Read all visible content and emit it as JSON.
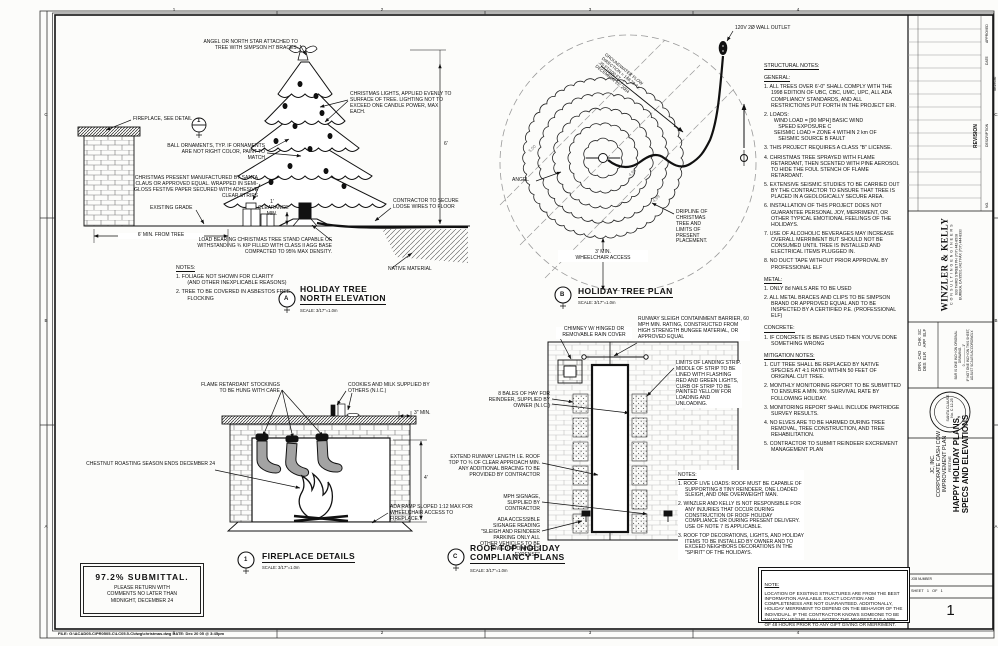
{
  "sheet": {
    "grid_cols": [
      "1",
      "2",
      "3",
      "4"
    ],
    "grid_rows_left": [
      "C",
      "B",
      "A"
    ],
    "grid_rows_right": [
      "C",
      "B",
      "A"
    ],
    "edge_code": "SE29536",
    "footer": "FILE: G:\\ACAD05-C\\PR0505-C\\LC05.5-C\\dwg\\christmas.dwg    DATE: Dec 20 05 @ 3:45pm"
  },
  "tree_elevation": {
    "tag": "A",
    "title": "HOLIDAY TREE\nNORTH ELEVATION",
    "scale": "SCALE: 3/17\"=1.0m",
    "labels": {
      "angel": "ANGEL OR NORTH STAR ATTACHED TO TREE WITH SIMPSON H7 BRACES.",
      "lights": "CHRISTMAS LIGHTS, APPLIED EVENLY TO SURFACE OF TREE. LIGHTING NOT TO EXCEED ONE CANDLE POWER, MAX EACH.",
      "fireplace_ref": "FIREPLACE, SEE DETAIL",
      "detail_ref_num": "1",
      "ornaments": "BALL ORNAMENTS, TYP. IF ORNAMENTS ARE NOT RIGHT COLOR, PAINT TO MATCH",
      "present": "CHRISTMAS PRESENT MANUFACTURED BY SANTA CLAUS OR APPROVED EQUAL. WRAPPED IN SEMI-GLOSS FESTIVE PAPER SECURED WITH ADHESIVE CLEAR STRIPS",
      "existing_grade": "EXISTING GRADE",
      "clearance": "1'\nCLEARANCE\nMIN.",
      "min_from_tree": "6' MIN. FROM TREE",
      "stand": "LOAD BEARING CHRISTMAS TREE STAND CAPABLE OF WITHSTANDING ¾ KIP FILLED WITH CLASS II AGG BASE COMPACTED TO 95% MAX DENSITY.",
      "wires": "CONTRACTOR TO SECURE LOOSE WIRES TO FLOOR",
      "native": "NATIVE MATERIAL",
      "height_dim": "6'"
    },
    "notes_heading": "NOTES:",
    "notes": [
      "1. FOLIAGE NOT SHOWN FOR CLARITY\n   (AND OTHER INEXPLICABLE REASONS)",
      "2. TREE TO BE COVERED IN ASBESTOS FREE\n   FLOCKING"
    ]
  },
  "tree_plan": {
    "tag": "B",
    "title": "HOLIDAY TREE PLAN",
    "scale": "SCALE: 3/17\"=1.0m",
    "labels": {
      "outlet": "120V 2Ø WALL OUTLET",
      "groundwater": "GROUNDWATER FLOW\nDIRECTION = 148.28 Az.\n.25 FT/100 FT.\nDECEMBER 25, 2004",
      "angel": "ANGEL",
      "dripline": "DRIPLINE OF CHRISTMAS TREE AND LIMITS OF PRESENT PLACEMENT.",
      "wheelchair": "3' MIN.\nWHEELCHAIR ACCESS",
      "contours": [
        "5.00",
        "4.98",
        "4.99"
      ]
    }
  },
  "roof_plan": {
    "tag": "C",
    "title": "ROOF TOP HOLIDAY\nCOMPLIANCY PLANS",
    "scale": "SCALE: 3/17\"=1.0m",
    "labels": {
      "chimney": "CHIMNEY W/ HINGED OR REMOVABLE RAIN COVER",
      "barrier": "RUNWAY SLEIGH CONTAINMENT BARRIER, 60 MPH MIN. RATING, CONSTRUCTED FROM HIGH STRENGTH BUNGEE MATERIAL, OR APPROVED EQUAL",
      "limits": "LIMITS OF LANDING STRIP. MIDDLE OF STRIP TO BE LINED WITH FLASHING RED AND GREEN LIGHTS, CURB OF STRIP TO BE PAINTED YELLOW FOR LOADING AND UNLOADING.",
      "hay": "8 BALES OF HAY FOR REINDEER, SUPPLIED BY OWNER (N.I.C.)",
      "runway": "EXTEND RUNWAY LENGTH I.E. ROOF TOP TO ¾ OF CLEAR APPROACH MIN. ANY ADDITIONAL BRACING TO BE PROVIDED BY CONTRACTOR",
      "mph": "MPH SIGNAGE, SUPPLIED BY CONTRACTOR",
      "ada": "ADA ACCESSIBLE SIGNAGE READING \"SLEIGH AND REINDEER PARKING ONLY ALL OTHER VEHICLES TO BE TOWED AT OWNER'S EXPENSE\""
    },
    "notes_heading": "NOTES:",
    "notes": [
      "1. ROOF LIVE LOADS: ROOF MUST BE CAPABLE OF SUPPORTING 8 TINY REINDEER, ONE LOADED SLEIGH, AND ONE OVERWEIGHT MAN.",
      "2. WINZLER AND KELLY IS NOT RESPONSIBLE FOR ANY INJURIES THAT OCCUR DURING CONSTRUCTION OF ROOF HOLIDAY COMPLIANCE OR DURING PRESENT DELIVERY. USE OF NOTE 7 IS APPLICABLE.",
      "3. ROOF TOP DECORATIONS, LIGHTS, AND HOLIDAY ITEMS TO BE INSTALLED BY OWNER AND TO EXCEED NEIGHBORS DECORATIONS IN THE \"SPIRIT\" OF THE HOLIDAYS."
    ]
  },
  "fireplace": {
    "tag": "1",
    "title": "FIREPLACE DETAILS",
    "scale": "SCALE: 3/17\"=1.0m",
    "labels": {
      "stockings": "FLAME RETARDANT STOCKINGS TO BE HUNG WITH CARE",
      "cookies": "COOKIES AND MILK SUPPLIED BY OTHERS (N.I.C.)",
      "three_min": "3\" MIN.",
      "chestnut": "CHESTNUT ROASTING SEASON ENDS DECEMBER 24",
      "ada_ramp": "ADA RAMP SLOPED 1:12 MAX FOR WHEELCHAIR ACCESS TO FIREPLACE.",
      "height_dim": "4'"
    }
  },
  "structural_notes": {
    "heading": "STRUCTURAL NOTES:",
    "general_heading": "GENERAL:",
    "general": [
      "1. ALL TREES OVER 6'-0\" SHALL COMPLY WITH THE 1998 EDITION OF UBC, CBC, UMC, UPC, ALL ADA COMPLIANCY STANDARDS, AND ALL RESTRICTIONS PUT FORTH IN THE PROJECT EIR.",
      "2. LOADS:\n  WIND LOAD = [90 MPH] BASIC WIND\n     SPEED EXPOSURE C\n  SEISMIC LOAD = ZONE 4 WITHIN 2 km OF\n     SEISMIC SOURCE B FAULT",
      "3. THIS PROJECT REQUIRES A CLASS \"B\" LICENSE.",
      "4. CHRISTMAS TREE SPRAYED WITH FLAME RETARDANT, THEN SCENTED WITH PINE AEROSOL TO HIDE THE FOUL STENCH OF FLAME RETARDANT.",
      "5. EXTENSIVE SEISMIC STUDIES TO BE CARRIED OUT BY THE CONTRACTOR TO ENSURE THAT TREE IS PLACED IN A GEOLOGICALLY SECURE AREA.",
      "6. INSTALLATION OF THIS PROJECT DOES NOT GUARANTEE PERSONAL JOY, MERRIMENT, OR OTHER TYPICAL EMOTIONAL FEELINGS OF THE HOLIDAYS.",
      "7. USE OF ALCOHOLIC BEVERAGES MAY INCREASE OVERALL MERRIMENT BUT SHOULD NOT BE CONSUMED UNTIL TREE IS INSTALLED AND ELECTRICAL ITEMS PLUGGED IN.",
      "8. NO DUCT TAPE WITHOUT PRIOR APPROVAL BY PROFESSIONAL ELF"
    ],
    "metal_heading": "METAL:",
    "metal": [
      "1. ONLY 8d NAILS ARE TO BE USED",
      "2. ALL METAL BRACES AND CLIPS TO BE SIMPSON BRAND OR APPROVED EQUAL AND TO BE INSPECTED BY A CERTIFIED P.E. (PROFESSIONAL ELF)"
    ],
    "concrete_heading": "CONCRETE:",
    "concrete": [
      "1. IF CONCRETE IS BEING USED THEN YOU'VE DONE SOMETHING WRONG"
    ],
    "mitigation_heading": "MITIGATION NOTES:",
    "mitigation": [
      "1. CUT TREE SHALL BE REPLACED BY NATIVE SPECIES AT 4:1 RATIO WITHIN 50 FEET OF ORIGINAL CUT TREE.",
      "2. MONTHLY MONITORING REPORT TO BE SUBMITTED TO ENSURE A MIN. 50% SURVIVAL RATE BY FOLLOWING HOLIDAY.",
      "3. MONITORING REPORT SHALL INCLUDE PARTRIDGE SURVEY RESULTS.",
      "4. NO ELVES ARE TO BE HARMED DURING TREE REMOVAL, TREE CONSTRUCTION, AND TREE REHABILITATION.",
      "5. CONTRACTOR TO SUBMIT REINDEER EXCREMENT MANAGEMENT PLAN"
    ]
  },
  "note_box": {
    "heading": "NOTE:",
    "body": "LOCATION OF EXISTING STRUCTURES ARE FROM THE BEST INFORMATION AVAILABLE. EXACT LOCATION AND COMPLETENESS ARE NOT GUARANTEED. ADDITIONALLY, HOLIDAY MERRIMENT TO DEPEND ON THE BEHAVIOR OF THE INDIVIDUAL. IF THE CONTRACTOR KNOWS SOMEONE TO BE NAUGHTY HE/SHE SHALL NOTIFY THE NEAREST ELF A MIN. OF 48 HOURS PRIOR TO ANY GIFT GIVING OR MERRIMENT."
  },
  "submittal": {
    "title": "97.2% SUBMITTAL.",
    "body": "PLEASE RETURN WITH\nCOMMENTS NO LATER THAN\nMIDNIGHT, DECEMBER 24"
  },
  "titleblock": {
    "firm_name": "WINZLER & KELLY",
    "firm_sub": "C O N S U L T I N G   E N G I N E E R S",
    "firm_addr1": "633 THIRD STREET        PH (707) 442-8508",
    "firm_addr2": "EUREKA, CA 95501-0417        FAX (707) 444-8330",
    "revision_label": "REVISION",
    "rev_approved": "APPROVED",
    "rev_date": "DATE",
    "rev_description": "DESCRIPTION",
    "rev_no": "NO.",
    "fields_line1": "DRN  CAD    CHK  SC",
    "fields_line2": "DES  ELR    APP  ELF",
    "bar_note1": "BAR IS ONE INCH ON ORIGINAL DRAWING.",
    "bar_note2": "0 ————— 1\"",
    "bar_note3": "IF NOT ONE INCH ON THIS SHEET, ADJUST SCALES ACCORDINGLY.",
    "seal_name": "SANTA CLAUSE",
    "seal_no": "No. C 12-25",
    "client": "JC, INC.",
    "project_line1": "CORPORATE CASH COW",
    "project_line2": "IMPROVEMENT PLAN",
    "phase": "FESTIVE",
    "sheet_title": "HAPPY HOLIDAY PLANS,\nSPECS AND ELEVATIONS",
    "job_label": "JOB NUMBER",
    "sheet_word": "SHEET",
    "sheet_no": "1",
    "of_word": "OF",
    "of_total": "1",
    "big_sheet_no": "1"
  }
}
